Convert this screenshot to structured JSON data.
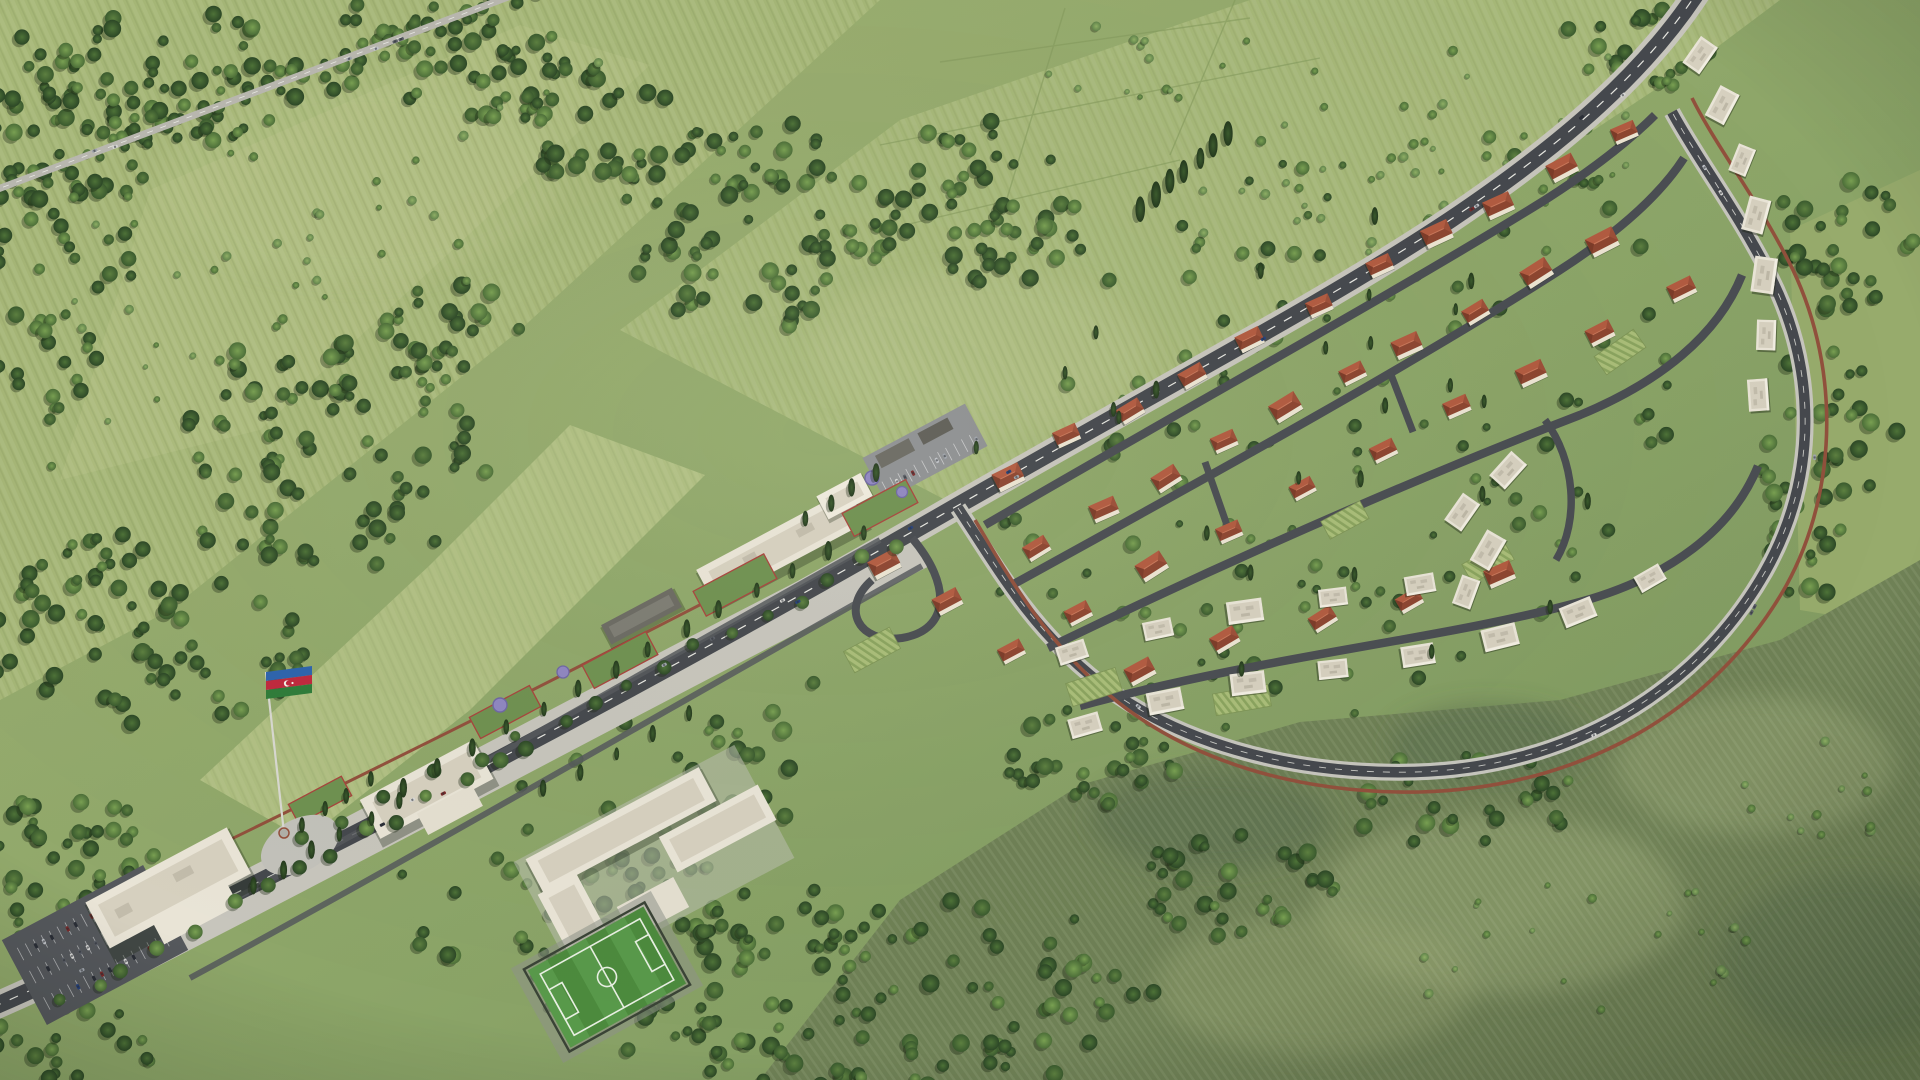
{
  "scene": {
    "title": "Aerial 3D masterplan rendering of a new linear village settlement along a tree-lined boulevard",
    "type": "architectural-visualization-aerial-view",
    "flag": {
      "country": "Azerbaijan",
      "stripe_blue": "#2e64ad",
      "stripe_red": "#c0293e",
      "stripe_green": "#2f7c39",
      "emblem_white": "#f2f3ea",
      "pole_color": "#d8d8d0"
    },
    "palette": {
      "field_base_light": "#a2b374",
      "field_base_mid": "#8ca568",
      "field_base_dark": "#78925c",
      "flag_meadow": "#aebe80",
      "scrub_bottom_right": "#6f8156",
      "scrub_mottle_light": "#9aa878",
      "scrub_mottle_dark": "#55684a",
      "forest_dark": "#2c4726",
      "forest_mid": "#3f6134",
      "forest_light": "#5d8040",
      "bush_light": "#7fa055",
      "road_asphalt": "#45484d",
      "road_sidewalk": "#c7c5bc",
      "road_marking": "#e8e8e2",
      "highway_gray": "#b9b8b0",
      "pedestrian_path_red": "#91503c",
      "planter_red": "#a8433c",
      "flowerbed_purple": "#8f86c0",
      "building_white": "#e9e4d6",
      "building_roof_gray": "#d6d0bf",
      "canopy_dark": "#6b6a62",
      "cottage_roof_light": "#b25b40",
      "cottage_roof_dark": "#8d4530",
      "pitch_green": "#4c8a3d",
      "pitch_stripe": "#58994a",
      "pitch_line": "#e8efe2",
      "parking_asphalt": "#55585c",
      "shadow_tint": "rgba(26,36,18,0.35)"
    },
    "features": [
      {
        "name": "main-boulevard",
        "description": "Diagonal main road from lower-left to upper-right with white lane markings, light sidewalks and street trees"
      },
      {
        "name": "tree-lined-highway",
        "description": "Existing highway with traffic crossing the upper-left fields, flanked by hedgerow trees"
      },
      {
        "name": "azerbaijan-flag",
        "description": "Large national flag on a tall pole beside the boulevard plaza"
      },
      {
        "name": "civic-buildings",
        "description": "White flat-roofed civic and commercial complexes along the boulevard"
      },
      {
        "name": "school-campus",
        "description": "U-shaped school complex with courtyards south of the boulevard"
      },
      {
        "name": "football-pitch",
        "description": "Fenced green mini football field with white markings next to the school"
      },
      {
        "name": "residential-teardrop",
        "description": "Loop-road neighborhood of detached terracotta-roof cottages with gardens and vineyards"
      },
      {
        "name": "apartment-arcs",
        "description": "Curved rows of white flat-roof townhouse blocks along the southern and eastern streets"
      },
      {
        "name": "perimeter-path",
        "description": "Terracotta-colored pedestrian loop path around the neighborhood"
      },
      {
        "name": "parking-lots",
        "description": "Asphalt parking areas with marked stalls and parked cars"
      },
      {
        "name": "forest-patches",
        "description": "Dense tree masses framing the site, large forest at bottom center"
      },
      {
        "name": "rough-meadow",
        "description": "Mottled scrubby grassland filling the bottom-right of the view"
      }
    ],
    "vehicles": {
      "car_colors": [
        "#d8d8d6",
        "#2b2f38",
        "#7b2a2a",
        "#24407c",
        "#c0c3c8",
        "#5a5e66",
        "#9fa4ab"
      ]
    }
  }
}
